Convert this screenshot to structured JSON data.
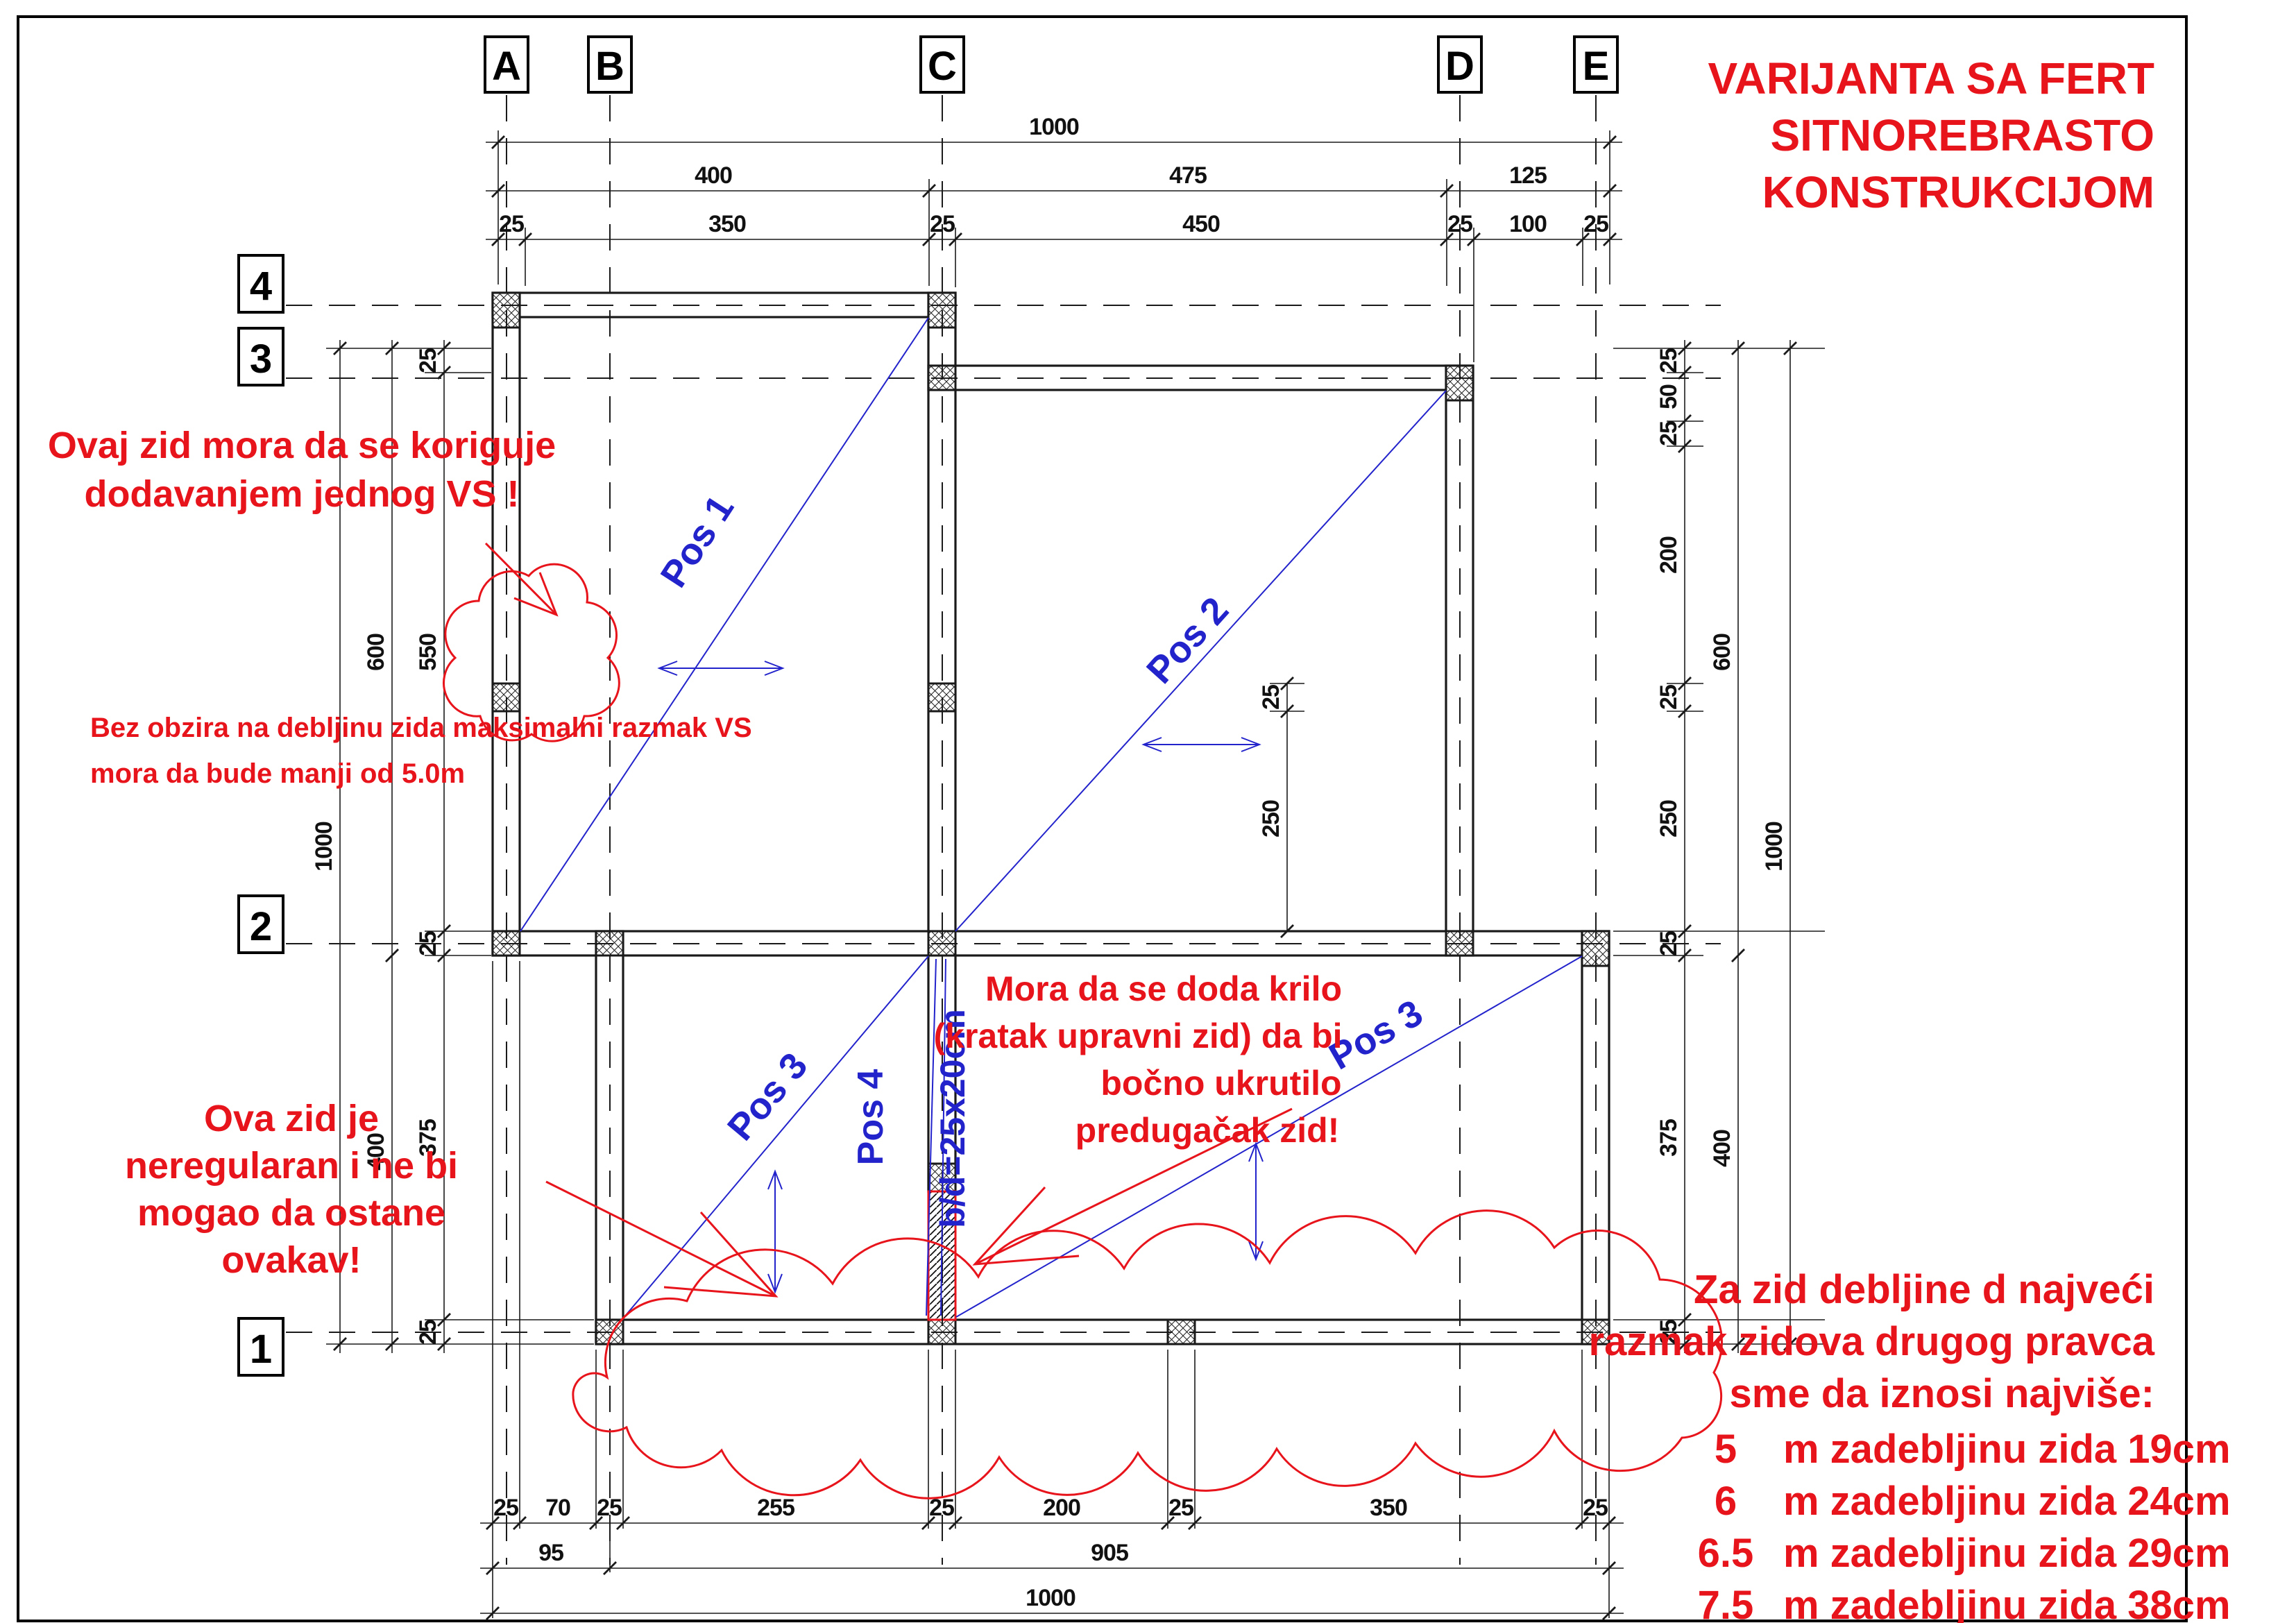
{
  "title": {
    "lines": [
      "VARIJANTA SA FERT",
      "SITNOREBRASTO",
      "KONSTRUKCIJOM"
    ]
  },
  "grid": {
    "cols": [
      "A",
      "B",
      "C",
      "D",
      "E"
    ],
    "rows": [
      "4",
      "3",
      "2",
      "1"
    ]
  },
  "pos_labels": {
    "pos1": "Pos 1",
    "pos2": "Pos 2",
    "pos3_left": "Pos 3",
    "pos3_right": "Pos 3",
    "pos4": "Pos 4",
    "beam": "b/d=25x20cm"
  },
  "annotations": {
    "koriguje": {
      "lines": [
        "Ovaj zid mora da se koriguje",
        "dodavanjem jednog VS !"
      ]
    },
    "bez_obzira": {
      "lines": [
        "Bez obzira na debljinu zida maksimalni razmak VS",
        "mora da bude manji od 5.0m"
      ]
    },
    "neregularan": {
      "lines": [
        "Ova zid je",
        "neregularan i ne bi",
        "mogao da ostane",
        "ovakav!"
      ]
    },
    "krilo": {
      "lines": [
        "Mora da se doda krilo",
        "(kratak upravni zid) da bi",
        "bočno ukrutilo",
        "predugačak zid!"
      ]
    },
    "pravilo": {
      "lines": [
        "Za zid debljine d najveći",
        "razmak zidova drugog pravca",
        "sme da iznosi najviše:"
      ],
      "rows": [
        {
          "n": "5",
          "t": "m zadebljinu zida 19cm"
        },
        {
          "n": "6",
          "t": "m zadebljinu zida 24cm"
        },
        {
          "n": "6.5",
          "t": "m zadebljinu zida 29cm"
        },
        {
          "n": "7.5",
          "t": "m zadebljinu zida 38cm"
        }
      ]
    }
  },
  "dims": {
    "top": {
      "total": "1000",
      "mid": [
        "400",
        "475",
        "125"
      ],
      "detail": [
        "25",
        "350",
        "25",
        "450",
        "25",
        "100",
        "25"
      ]
    },
    "bottom": {
      "total": "1000",
      "mid": [
        "95",
        "905"
      ],
      "detail": [
        "25",
        "70",
        "25",
        "255",
        "25",
        "200",
        "25",
        "350",
        "25"
      ]
    },
    "left": {
      "total": "1000",
      "mid": [
        "600",
        "400"
      ],
      "detail": [
        "25",
        "550",
        "25",
        "375",
        "25"
      ]
    },
    "right": {
      "total": "1000",
      "mid": [
        "600",
        "400"
      ],
      "detail": [
        "25",
        "50",
        "25",
        "200",
        "25",
        "250",
        "25",
        "375",
        "25"
      ]
    },
    "interior": [
      "25",
      "250"
    ]
  },
  "colors": {
    "red": "#e8141c",
    "blue": "#2323cc",
    "black": "#1a1a1a"
  }
}
